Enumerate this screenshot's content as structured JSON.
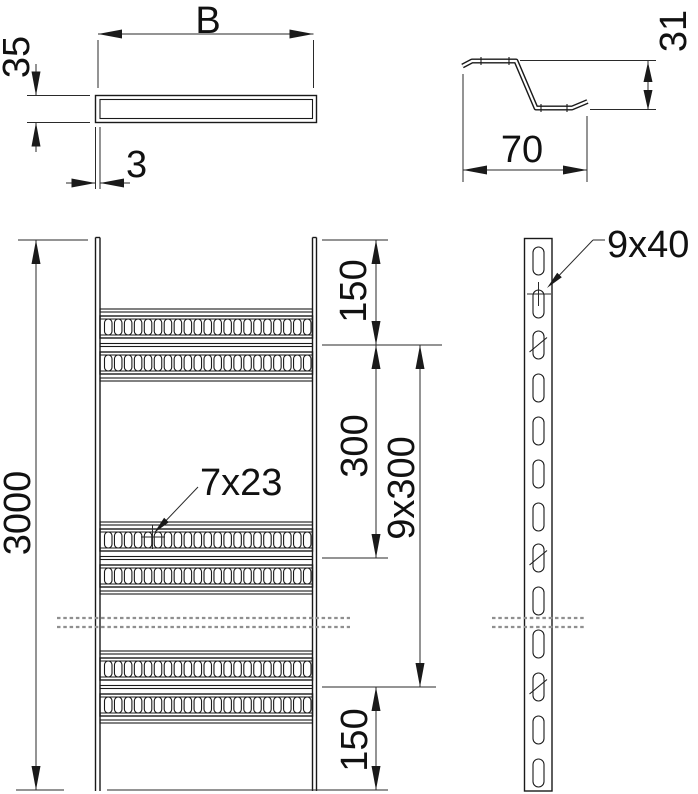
{
  "front_view": {
    "width_label": "B",
    "height_label": "35",
    "thickness_label": "3"
  },
  "rung_profile_view": {
    "height_label": "31",
    "width_label": "70"
  },
  "plan_view": {
    "length_label": "3000",
    "top_end_spacing_label": "150",
    "rung_pitch_label": "300",
    "pitch_pattern_label": "9x300",
    "bottom_end_spacing_label": "150",
    "rung_slot_label": "7x23"
  },
  "side_rail_view": {
    "rail_slot_label": "9x40"
  },
  "colors": {
    "line": "#1a1a1a",
    "dimension": "#2a2a2a",
    "break_line": "#8f8f8f",
    "background": "#ffffff"
  }
}
